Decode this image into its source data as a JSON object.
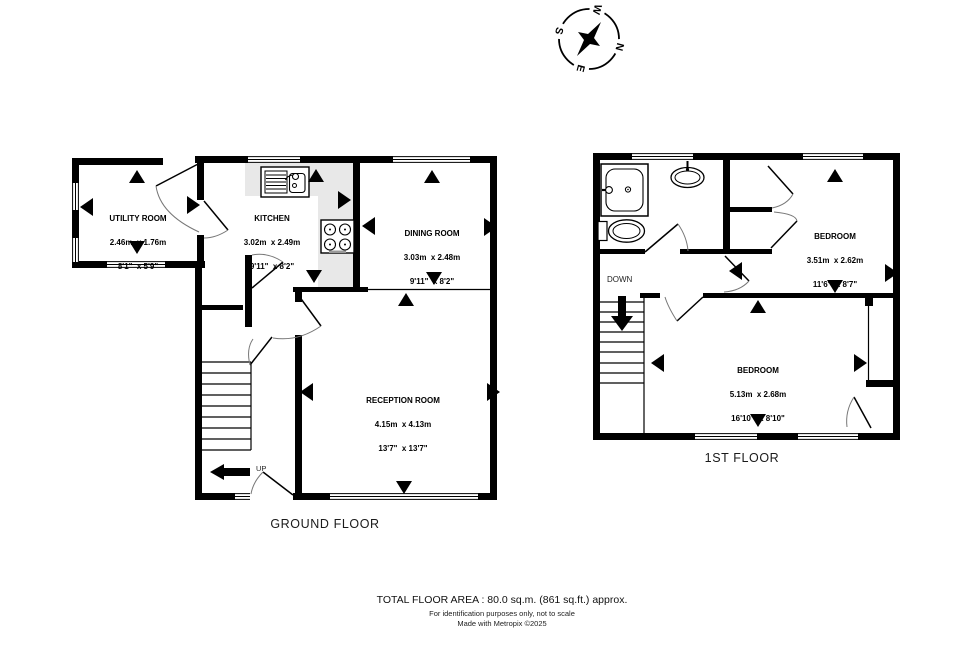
{
  "compass": {
    "n": "N",
    "e": "E",
    "s": "S",
    "w": "W"
  },
  "ground_floor": {
    "label": "GROUND FLOOR",
    "up_label": "UP",
    "rooms": [
      {
        "name": "UTILITY ROOM",
        "metric": "2.46m  x 1.76m",
        "imperial": "8'1\"  x 5'9\""
      },
      {
        "name": "KITCHEN",
        "metric": "3.02m  x 2.49m",
        "imperial": "9'11\"  x 8'2\""
      },
      {
        "name": "DINING ROOM",
        "metric": "3.03m  x 2.48m",
        "imperial": "9'11\"  x 8'2\""
      },
      {
        "name": "RECEPTION ROOM",
        "metric": "4.15m  x 4.13m",
        "imperial": "13'7\"  x 13'7\""
      }
    ]
  },
  "first_floor": {
    "label": "1ST FLOOR",
    "down_label": "DOWN",
    "rooms": [
      {
        "name": "BEDROOM",
        "metric": "3.51m  x 2.62m",
        "imperial": "11'6\"  x 8'7\""
      },
      {
        "name": "BEDROOM",
        "metric": "5.13m  x 2.68m",
        "imperial": "16'10\"  x 8'10\""
      }
    ]
  },
  "footer": {
    "total_area": "TOTAL FLOOR AREA : 80.0 sq.m. (861 sq.ft.) approx.",
    "disclaimer": "For identification purposes only, not to scale",
    "credit": "Made with Metropix ©2025"
  },
  "colors": {
    "wall": "#000000",
    "kitchen_floor": "#e8e8e8"
  }
}
